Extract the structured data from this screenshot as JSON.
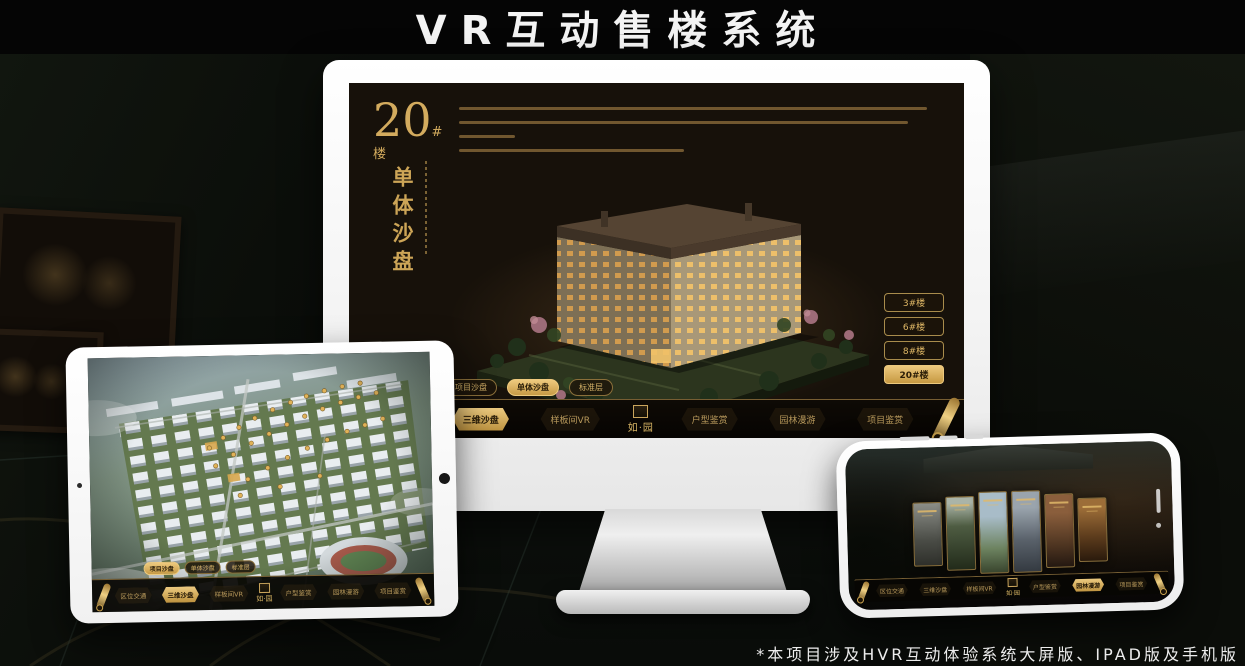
{
  "page": {
    "title": "VR互动售楼系统",
    "footnote": "*本项目涉及HVR互动体验系统大屏版、IPAD版及手机版"
  },
  "colors": {
    "gold": "#cda557",
    "gold_bright": "#eeca7e",
    "screen_bg": "#17110a",
    "bar_bg": "#0a0804"
  },
  "monitor": {
    "heading": {
      "number": "20",
      "suffix": "#楼",
      "subtitle": "单体沙盘"
    },
    "floor_buttons": [
      {
        "label": "3#楼",
        "active": false
      },
      {
        "label": "6#楼",
        "active": false
      },
      {
        "label": "8#楼",
        "active": false
      },
      {
        "label": "20#楼",
        "active": true
      }
    ],
    "tabs": [
      {
        "label": "项目沙盘",
        "active": false
      },
      {
        "label": "单体沙盘",
        "active": true
      },
      {
        "label": "标准层",
        "active": false
      }
    ],
    "nav": {
      "logo": "如·园",
      "items": [
        {
          "label": "区位交通",
          "active": false
        },
        {
          "label": "三维沙盘",
          "active": true
        },
        {
          "label": "样板间VR",
          "active": false
        },
        {
          "label": "户型鉴赏",
          "active": false
        },
        {
          "label": "园林漫游",
          "active": false
        },
        {
          "label": "项目鉴赏",
          "active": false
        }
      ]
    }
  },
  "tablet": {
    "tabs": [
      {
        "label": "项目沙盘",
        "active": true
      },
      {
        "label": "单体沙盘",
        "active": false
      },
      {
        "label": "标准层",
        "active": false
      }
    ],
    "nav": {
      "logo": "如·园",
      "items": [
        {
          "label": "区位交通",
          "active": false
        },
        {
          "label": "三维沙盘",
          "active": true
        },
        {
          "label": "样板间VR",
          "active": false
        },
        {
          "label": "户型鉴赏",
          "active": false
        },
        {
          "label": "园林漫游",
          "active": false
        },
        {
          "label": "项目鉴赏",
          "active": false
        }
      ]
    }
  },
  "phone": {
    "nav": {
      "logo": "如·园",
      "items": [
        {
          "label": "区位交通",
          "active": false
        },
        {
          "label": "三维沙盘",
          "active": false
        },
        {
          "label": "样板间VR",
          "active": false
        },
        {
          "label": "户型鉴赏",
          "active": false
        },
        {
          "label": "园林漫游",
          "active": true
        },
        {
          "label": "项目鉴赏",
          "active": false
        }
      ]
    }
  }
}
